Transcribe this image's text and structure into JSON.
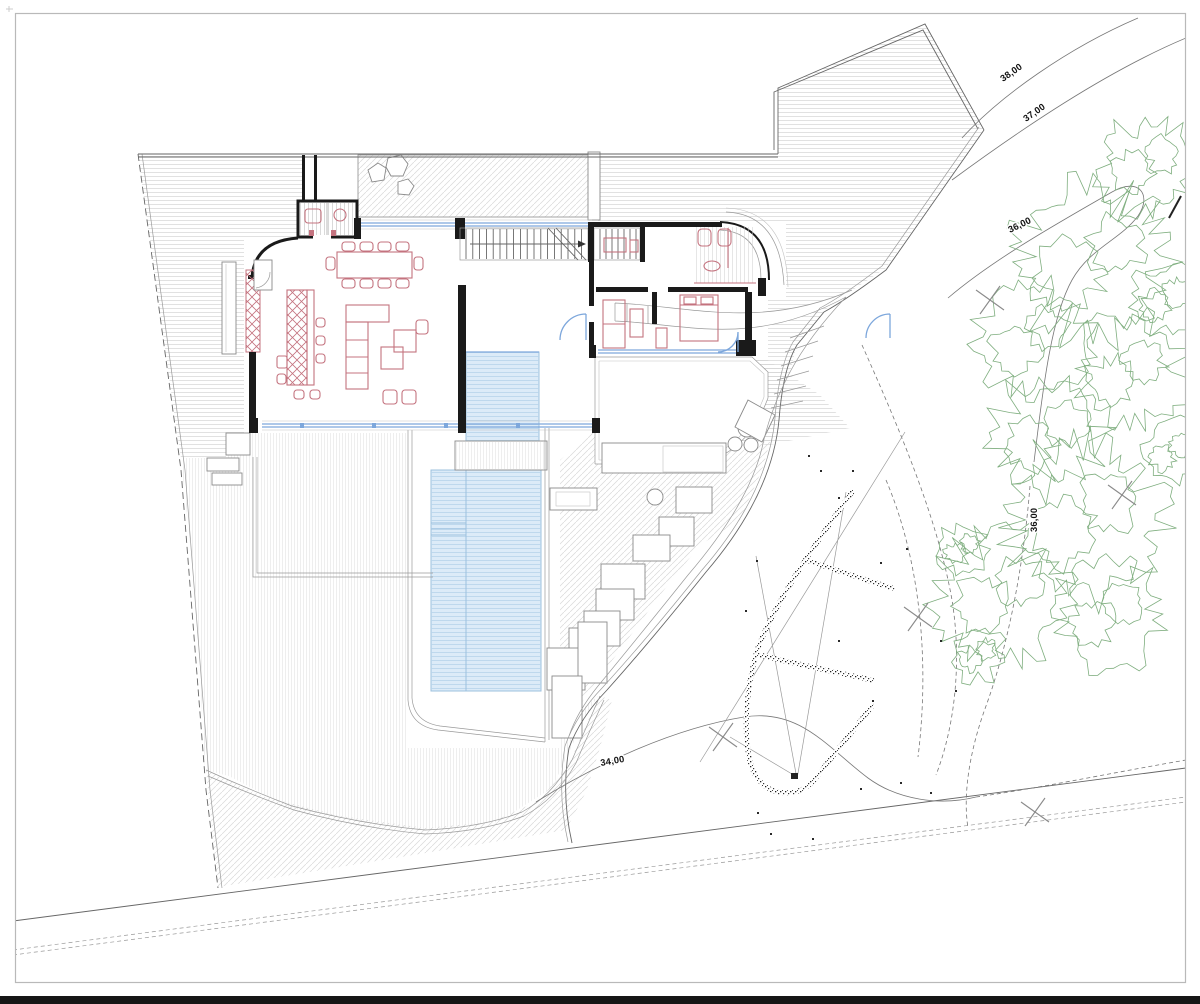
{
  "page": {
    "background": "#ffffff",
    "footer_bar_color": "#161616",
    "frame_color": "#b9b9b9"
  },
  "colors": {
    "paper": "#ffffff",
    "wall": "#1a1a1a",
    "line": "#666666",
    "furniture_red": "#c4737f",
    "glazing_blue": "#7da7dc",
    "pool_fill": "#dcebf8",
    "pool_line": "#9cc0de",
    "vegetation_green": "#7fae7f",
    "hatch_gray": "#d6d6d6",
    "label": "#111111",
    "footer": "#161616"
  },
  "annotations": {
    "contour_labels": [
      {
        "text": "38,00"
      },
      {
        "text": "37,00"
      },
      {
        "text": "36,00"
      },
      {
        "text": "36,00"
      },
      {
        "text": "34,00"
      }
    ]
  }
}
